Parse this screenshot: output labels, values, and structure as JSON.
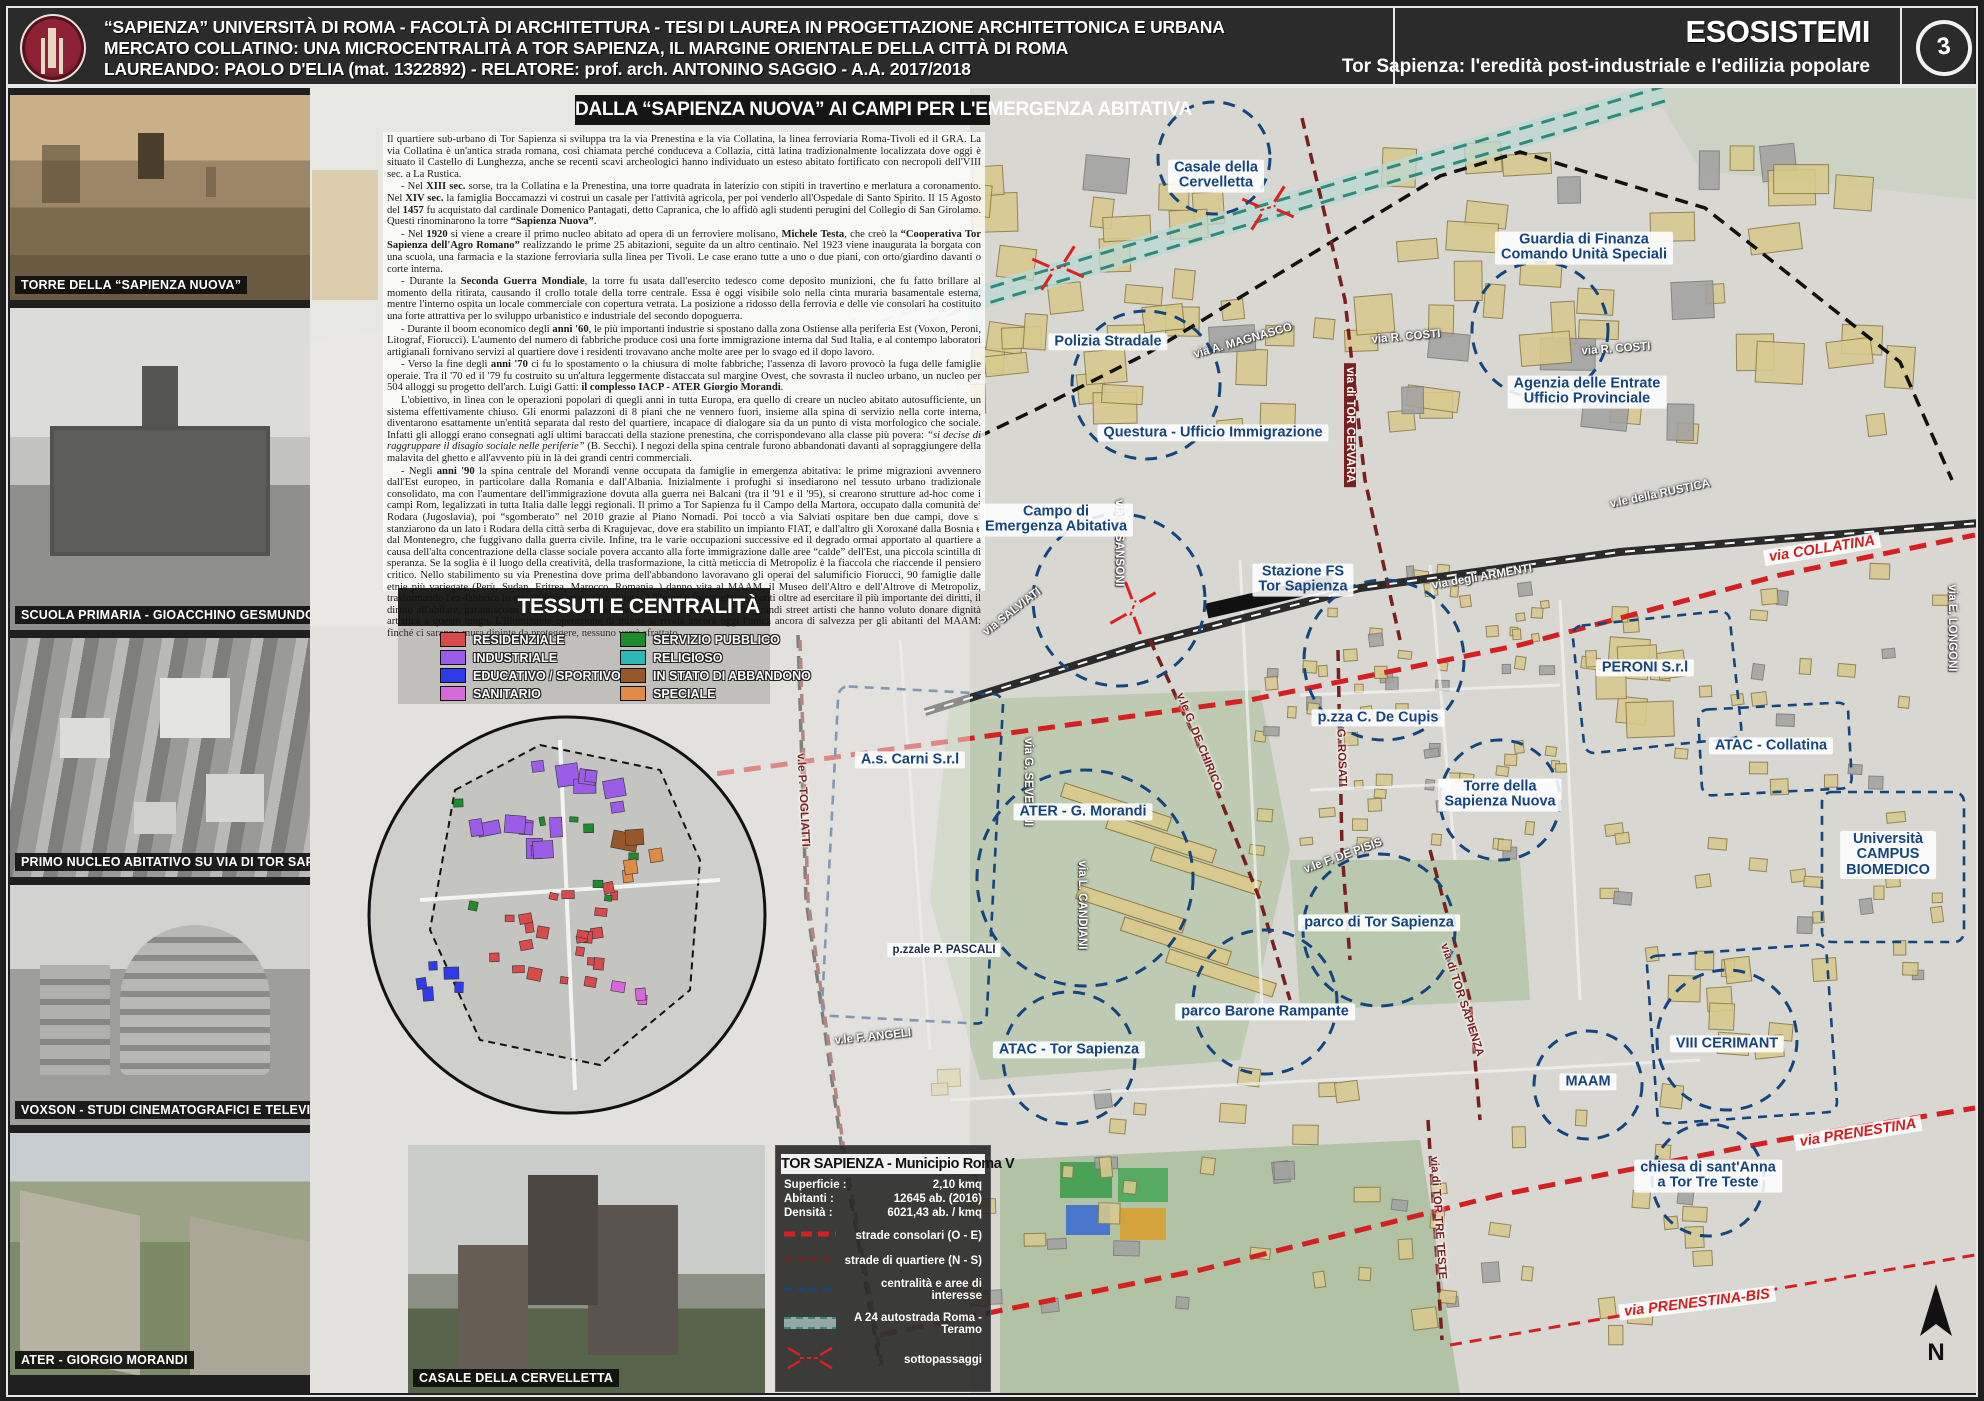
{
  "header": {
    "line1": "“SAPIENZA” UNIVERSITÀ DI ROMA  -  FACOLTÀ DI ARCHITETTURA - TESI DI LAUREA IN PROGETTAZIONE ARCHITETTONICA E URBANA",
    "line2": "MERCATO COLLATINO:  UNA MICROCENTRALITÀ A TOR SAPIENZA, IL MARGINE ORIENTALE DELLA CITTÀ DI ROMA",
    "line3": "LAUREANDO: PAOLO D'ELIA (mat. 1322892)  -  RELATORE: prof. arch. ANTONINO SAGGIO  -  A.A. 2017/2018",
    "series_title": "ESOSISTEMI",
    "series_subtitle": "Tor Sapienza: l'eredità post-industriale e l'edilizia popolare",
    "sheet_number": "3",
    "logo": "sapienza-crest"
  },
  "photos": [
    {
      "caption": "TORRE DELLA “SAPIENZA NUOVA”"
    },
    {
      "caption": "SCUOLA PRIMARIA - GIOACCHINO GESMUNDO - P.ZZA C. DE CUPIS"
    },
    {
      "caption": "PRIMO NUCLEO ABITATIVO SU VIA DI TOR SAPIENZA"
    },
    {
      "caption": "VOXSON - STUDI CINEMATOGRAFICI E TELEVISIVI"
    },
    {
      "caption": "ATER - GIORGIO MORANDI"
    }
  ],
  "casale_photo": {
    "caption": "CASALE DELLA CERVELLETTA"
  },
  "article": {
    "title": "DALLA “SAPIENZA NUOVA” AI CAMPI PER L'EMERGENZA ABITATIVA",
    "paragraphs": [
      "Il quartiere sub-urbano di Tor Sapienza si sviluppa tra la via Prenestina e la via Collatina, la linea ferroviaria Roma-Tivoli ed il GRA. La via Collatina è un'antica strada romana, così chiamata perché conduceva a Collazia, città latina tradizionalmente localizzata dove oggi è situato il Castello di Lunghezza, anche se recenti scavi archeologici hanno individuato un esteso abitato fortificato con necropoli dell'VIII sec. a La Rustica.",
      "- Nel **XIII sec.** sorse, tra la Collatina e la Prenestina, una torre quadrata in laterizio con stipiti in travertino e merlatura a coronamento. Nel **XIV sec.** la famiglia Boccamazzi vi costruì un casale per l'attività agricola, per poi venderlo all'Ospedale di Santo Spirito. Il 15 Agosto del **1457** fu acquistato dal cardinale Domenico Pantagati, detto Capranica, che lo affidò agli studenti perugini del Collegio di San Girolamo. Questi rinominarono la torre **“Sapienza Nuova”**.",
      "- Nel **1920** si viene a creare il primo nucleo abitato ad opera di un ferroviere molisano, **Michele Testa**, che creò la **“Cooperativa Tor Sapienza dell'Agro Romano”** realizzando le prime 25 abitazioni, seguite da un altro centinaio. Nel 1923 viene inaugurata la borgata con una scuola, una farmacia e la stazione ferroviaria sulla linea per Tivoli. Le case erano tutte a uno o due piani, con orto/giardino davanti o corte interna.",
      "- Durante la **Seconda Guerra Mondiale**, la torre fu usata dall'esercito tedesco come deposito munizioni, che fu fatto brillare al momento della ritirata, causando il crollo totale della torre centrale. Essa è oggi visibile solo nella cinta muraria basamentale esterna, mentre l'interno ospita un locale commerciale con copertura vetrata. La posizione a ridosso della ferrovia e delle vie consolari ha costituito una forte attrattiva per lo sviluppo urbanistico e industriale del secondo dopoguerra.",
      "- Durante il boom economico degli **anni '60**, le più importanti industrie si spostano dalla zona Ostiense alla periferia Est (Voxon, Peroni, Litograf, Fiorucci). L'aumento del numero di fabbriche produce così una forte immigrazione interna dal Sud Italia, e al contempo laboratori artigianali fornivano servizi al quartiere dove i residenti trovavano anche molte aree per lo svago ed il dopo lavoro.",
      "- Verso la fine degli **anni '70** ci fu lo spostamento o la chiusura di molte fabbriche; l'assenza di lavoro provocò la fuga delle famiglie operaie. Tra il '70 ed il '79 fu costruito su un'altura leggermente distaccata sul margine Ovest, che sovrasta il nucleo urbano, un nucleo per 504 alloggi su progetto dell'arch. Luigi Gatti: **il complesso IACP - ATER Giorgio Morandi**.",
      "L'obiettivo, in linea con le operazioni popolari di quegli anni in tutta Europa, era quello di creare un nucleo abitato autosufficiente, un sistema effettivamente chiuso. Gli enormi palazzoni di 8 piani che ne vennero fuori, insieme alla spina di servizio nella corte interna, diventarono esattamente un'entità separata dal resto del quartiere, incapace di dialogare sia da un punto di vista morfologico che sociale. Infatti gli alloggi erano consegnati agli ultimi baraccati della stazione prenestina, che corrispondevano alla classe più povera: *“si decise di raggruppare il disagio sociale nelle periferie”* (B. Secchi). I negozi della spina centrale furono abbandonati davanti al sopraggiungere della malavita del ghetto e all'avvento più in là dei grandi centri commerciali.",
      "- Negli **anni '90** la spina centrale del Morandi venne occupata da famiglie in emergenza abitativa: le prime migrazioni avvennero dall'Est europeo, in particolare dalla Romania e dall'Albania. Inizialmente i profughi si insediarono nel tessuto urbano tradizionale consolidato, ma con l'aumentare dell'immigrazione dovuta alla guerra nei Balcani (tra il '91 e il '95), si crearono strutture ad-hoc come i campi Rom, legalizzati in tutta Italia dalle leggi regionali. Il primo a Tor Sapienza fu il Campo della Martora, occupato dalla comunità dei Rodara (Jugoslavia), poi “sgomberato” nel 2010 grazie al Piano Nomadi. Poi toccò a via Salviati ospitare ben due campi, dove si stanziarono da un lato i Rodara della città serba di Kragujevac, dove era stabilito un impianto FIAT, e dall'altro gli Xoroxané dalla Bosnia e dal Montenegro, che fuggivano dalla guerra civile. Infine, tra le varie occupazioni successive ed il degrado ormai apportato al quartiere a causa dell'alta concentrazione della classe sociale povera accanto alla forte immigrazione dalle aree “calde” dell'Est, una piccola scintilla di speranza. Se la soglia è il luogo della creatività, della trasformazione, la città meticcia di Metropoliz è la fiaccola che riaccende il pensiero critico. Nello stabilimento su via Prenestina dove prima dell'abbandono lavoravano gli operai del salumificio Fiorucci, 90 famiglie dalle etnie più variegate (Perù, Sudan, Eritrea, Marocco, Romania..) danno vita al MAAM, il Museo dell'Altro e dell'Altrove di Metropoliz, trasformando l'ex-fabbrica in una galleria espositiva abitata. All'interno infatti gli occupanti oltre ad esercitare il più importante dei diritti, il diritto all'abitare, garantiscono la custodia e la tutela delle opere d'arte “offerte” dai grandi street artisti che hanno voluto donare dignità artistica a questo luogo. L'illuminante operazione di mixité si rivela ancora oggi l'unica ancora di salvezza per gli abitanti del MAAM: finché ci saranno mura dipinte da proteggere, nessuno verrà sfrattato..."
    ]
  },
  "tessuti_legend": {
    "title": "TESSUTI E CENTRALITÀ",
    "items": [
      {
        "label": "RESIDENZIALE",
        "color": "#d94a4a"
      },
      {
        "label": "INDUSTRIALE",
        "color": "#9b5ce8"
      },
      {
        "label": "EDUCATIVO / SPORTIVO",
        "color": "#2f3ae8"
      },
      {
        "label": "SANITARIO",
        "color": "#d768d7"
      },
      {
        "label": "SERVIZIO PUBBLICO",
        "color": "#1f8c2c"
      },
      {
        "label": "RELIGIOSO",
        "color": "#2cb8b8"
      },
      {
        "label": "IN STATO DI ABBANDONO",
        "color": "#96582b"
      },
      {
        "label": "SPECIALE",
        "color": "#e08a48"
      }
    ]
  },
  "info_box": {
    "title": "TOR SAPIENZA - Municipio Roma V",
    "stats": [
      {
        "label": "Superficie :",
        "value": "2,10 kmq"
      },
      {
        "label": "Abitanti :",
        "value": "12645 ab. (2016)"
      },
      {
        "label": "Densità :",
        "value": "6021,43 ab. / kmq"
      }
    ],
    "legend": [
      {
        "symbol": "consolari",
        "label": "strade consolari (O - E)"
      },
      {
        "symbol": "quartiere",
        "label": "strade di quartiere (N - S)"
      },
      {
        "symbol": "centralita",
        "label": "centralità e aree di interesse"
      },
      {
        "symbol": "a24",
        "label": "A 24 autostrada Roma - Teramo"
      },
      {
        "symbol": "sottopassaggi",
        "label": "sottopassaggi"
      }
    ]
  },
  "map": {
    "poi_labels": [
      {
        "text": "Casale della\nCervelletta",
        "x": 1216,
        "y": 176
      },
      {
        "text": "Guardia di Finanza\nComando Unità Speciali",
        "x": 1584,
        "y": 248
      },
      {
        "text": "Polizia Stradale",
        "x": 1108,
        "y": 342
      },
      {
        "text": "Questura - Ufficio Immigrazione",
        "x": 1213,
        "y": 433
      },
      {
        "text": "Agenzia delle Entrate\nUfficio Provinciale",
        "x": 1587,
        "y": 392
      },
      {
        "text": "Campo di\nEmergenza Abitativa",
        "x": 1056,
        "y": 520
      },
      {
        "text": "Stazione FS\nTor Sapienza",
        "x": 1303,
        "y": 580
      },
      {
        "text": "p.zza C. De Cupis",
        "x": 1378,
        "y": 718
      },
      {
        "text": "PERONI S.r.l",
        "x": 1645,
        "y": 668
      },
      {
        "text": "ATAC - Collatina",
        "x": 1771,
        "y": 746
      },
      {
        "text": "A.s. Carni S.r.l",
        "x": 910,
        "y": 760
      },
      {
        "text": "Torre della\nSapienza Nuova",
        "x": 1500,
        "y": 795
      },
      {
        "text": "ATER - G. Morandi",
        "x": 1083,
        "y": 812
      },
      {
        "text": "Università\nCAMPUS\nBIOMEDICO",
        "x": 1888,
        "y": 855
      },
      {
        "text": "parco di Tor Sapienza",
        "x": 1379,
        "y": 923
      },
      {
        "text": "parco Barone Rampante",
        "x": 1265,
        "y": 1012
      },
      {
        "text": "ATAC - Tor Sapienza",
        "x": 1069,
        "y": 1050
      },
      {
        "text": "VIII CERIMANT",
        "x": 1727,
        "y": 1044
      },
      {
        "text": "MAAM",
        "x": 1588,
        "y": 1082
      },
      {
        "text": "chiesa di sant'Anna\na Tor Tre Teste",
        "x": 1708,
        "y": 1176
      }
    ],
    "street_labels": [
      {
        "text": "via A. MAGNASCO",
        "x": 1243,
        "y": 341,
        "rot": -16,
        "style": "w"
      },
      {
        "text": "via R. COSTI",
        "x": 1406,
        "y": 337,
        "rot": -5,
        "style": "w"
      },
      {
        "text": "via R. COSTI",
        "x": 1616,
        "y": 349,
        "rot": -4,
        "style": "w"
      },
      {
        "text": "via di TOR CERVARA",
        "x": 1350,
        "y": 425,
        "rot": 90,
        "style": "c"
      },
      {
        "text": "via degli ARMENTI",
        "x": 1482,
        "y": 577,
        "rot": -10,
        "style": "w"
      },
      {
        "text": "v.le della RUSTICA",
        "x": 1660,
        "y": 494,
        "rot": -12,
        "style": "w"
      },
      {
        "text": "via E. LONGONI",
        "x": 1952,
        "y": 628,
        "rot": 90,
        "style": "w"
      },
      {
        "text": "via G. SANSONI",
        "x": 1119,
        "y": 543,
        "rot": 90,
        "style": "w"
      },
      {
        "text": "via SALVIATI",
        "x": 1012,
        "y": 612,
        "rot": -38,
        "style": "w"
      },
      {
        "text": "via G. SEVERINI",
        "x": 1028,
        "y": 782,
        "rot": 90,
        "style": "w"
      },
      {
        "text": "via L. CANDIANI",
        "x": 1082,
        "y": 905,
        "rot": 90,
        "style": "w"
      },
      {
        "text": "v.le F. DE PISIS",
        "x": 1343,
        "y": 856,
        "rot": -20,
        "style": "w"
      },
      {
        "text": "v.le F. ANGELI",
        "x": 873,
        "y": 1037,
        "rot": -6,
        "style": "w"
      },
      {
        "text": "v.le G. DE CHIRICO",
        "x": 1199,
        "y": 742,
        "rot": 68,
        "style": "d"
      },
      {
        "text": "via G. ROSATI",
        "x": 1341,
        "y": 748,
        "rot": 88,
        "style": "d"
      },
      {
        "text": "via di TOR SAPIENZA",
        "x": 1462,
        "y": 1000,
        "rot": 72,
        "style": "d"
      },
      {
        "text": "via di TOR TRE TESTE",
        "x": 1438,
        "y": 1218,
        "rot": 86,
        "style": "d"
      },
      {
        "text": "v.le P. TOGLIATTI",
        "x": 803,
        "y": 800,
        "rot": 87,
        "style": "d"
      },
      {
        "text": "p.zzale P. PASCALI",
        "x": 944,
        "y": 950,
        "rot": 0,
        "style": "b"
      }
    ],
    "route_labels": [
      {
        "text": "via COLLATINA",
        "x": 1822,
        "y": 549,
        "rot": -9
      },
      {
        "text": "via PRENESTINA",
        "x": 1858,
        "y": 1133,
        "rot": -9
      },
      {
        "text": "via PRENESTINA-BIS",
        "x": 1697,
        "y": 1303,
        "rot": -7
      }
    ],
    "compass": "N"
  },
  "colors": {
    "poi_blue": "#15457f",
    "route_red": "#d42020",
    "quartiere_darkred": "#7a1f1f",
    "a24_teal": "#2e8b7a",
    "map_base": "#d8d7d2"
  }
}
